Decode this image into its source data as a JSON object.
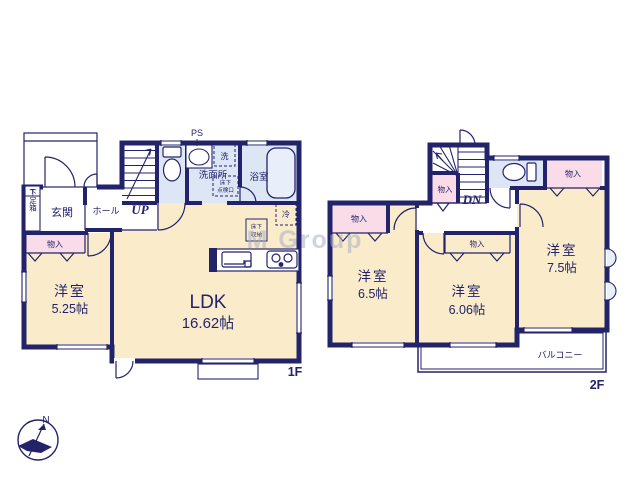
{
  "watermark": "M Group",
  "compass": {
    "north_label": "N"
  },
  "colors": {
    "wall": "#23236b",
    "room_cream": "#faeccb",
    "wet_blue": "#dde6f4",
    "closet_pink": "#fadce8",
    "white": "#ffffff",
    "watermark_gray": "#a8afc6"
  },
  "floor1": {
    "label": "1F",
    "entrance": "玄関",
    "hall": "ホール",
    "shoe_box_top": "T",
    "shoe_box": "下足箱",
    "stairs_label": "UP",
    "pipe_space": "PS",
    "washroom": "洗面所",
    "washer": "洗",
    "bathroom": "浴室",
    "floor_hatch_line1": "床下",
    "floor_hatch_line2": "点検口",
    "fridge": "冷",
    "floor_storage_line1": "床下",
    "floor_storage_line2": "収納",
    "closet": "物入",
    "ldk": {
      "name": "LDK",
      "area": "16.62帖"
    },
    "bedroom": {
      "name": "洋室",
      "area": "5.25帖"
    }
  },
  "floor2": {
    "label": "2F",
    "stairs_label": "DN",
    "closet": "物入",
    "balcony": "バルコニー",
    "bedroom_a": {
      "name": "洋室",
      "area": "6.5帖"
    },
    "bedroom_b": {
      "name": "洋室",
      "area": "6.06帖"
    },
    "bedroom_c": {
      "name": "洋室",
      "area": "7.5帖"
    }
  }
}
